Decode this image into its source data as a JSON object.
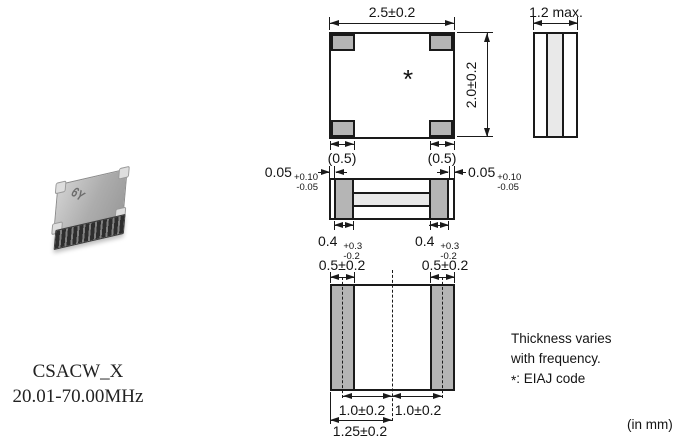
{
  "product": {
    "series": "CSACW_X",
    "frequency_range": "20.01-70.00MHz",
    "chip_marking": "6Y"
  },
  "top_view": {
    "width": "2.5±0.2",
    "height": "2.0±0.2",
    "corner_pad_left": "(0.5)",
    "corner_pad_right": "(0.5)",
    "eiaj_mark": "*"
  },
  "side_view": {
    "thickness": "1.2 max."
  },
  "front_view": {
    "gap_left": {
      "value": "0.05",
      "plus": "+0.10",
      "minus": "-0.05"
    },
    "gap_right": {
      "value": "0.05",
      "plus": "+0.10",
      "minus": "-0.05"
    },
    "pad_left": {
      "value": "0.4",
      "plus": "+0.3",
      "minus": "-0.2"
    },
    "pad_right": {
      "value": "0.4",
      "plus": "+0.3",
      "minus": "-0.2"
    }
  },
  "bottom_view": {
    "pad_width_left": "0.5±0.2",
    "pad_width_right": "0.5±0.2",
    "pad_pitch_left": "1.0±0.2",
    "pad_pitch_right": "1.0±0.2",
    "edge_to_center": "1.25±0.2"
  },
  "notes": {
    "line1": "Thickness varies",
    "line2": "with frequency.",
    "symbol": "*",
    "symbol_meaning": ": EIAJ code",
    "units": "(in mm)"
  },
  "colors": {
    "pad_fill": "#b5b5b5",
    "ceramic_fill": "#e9e9e9",
    "line": "#1a1a1a"
  }
}
